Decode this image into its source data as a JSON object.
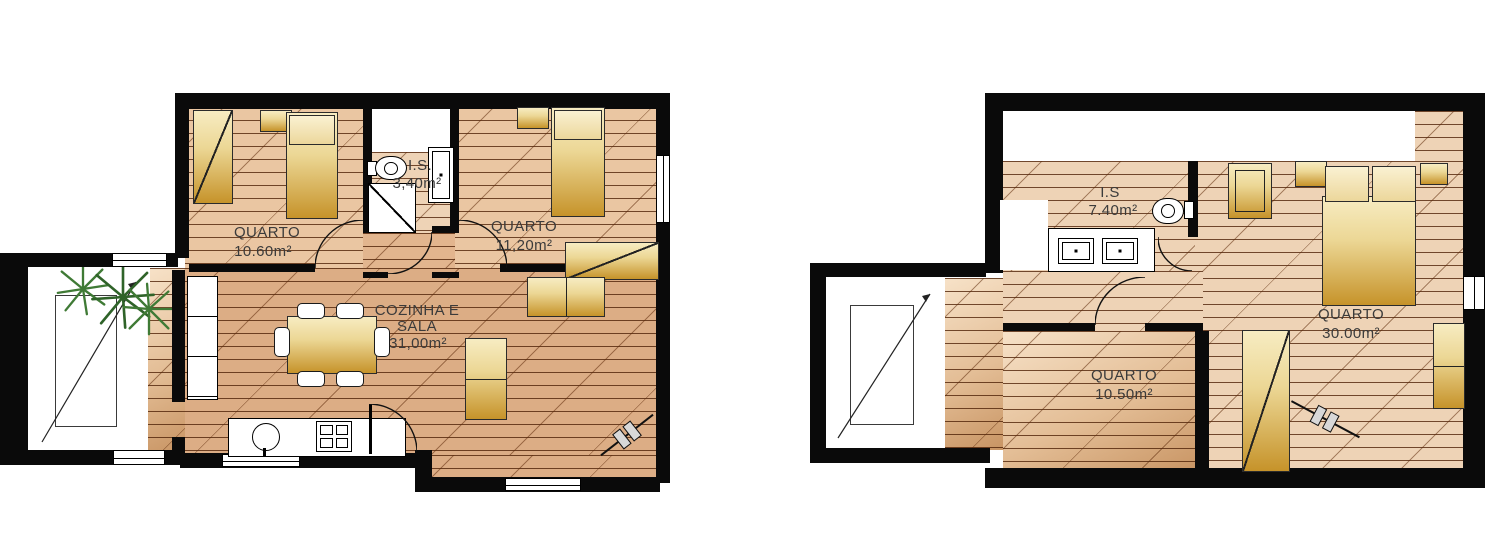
{
  "colors": {
    "wall": "#0a0a0a",
    "floor": "#e2b58e",
    "furniture": "#c6932a",
    "plant": "#3f7a35",
    "text": "#3b3b3b"
  },
  "plans": [
    {
      "label": "ground-floor",
      "rooms": [
        {
          "name": "QUARTO",
          "area": "10.60m²"
        },
        {
          "name": "I.S.",
          "area": "3,40m²"
        },
        {
          "name": "QUARTO",
          "area": "11,20m²"
        },
        {
          "name_line1": "COZINHA E",
          "name_line2": "SALA",
          "area": "31,00m²"
        }
      ]
    },
    {
      "label": "upper-floor",
      "rooms": [
        {
          "name": "I.S",
          "area": "7.40m²"
        },
        {
          "name": "QUARTO",
          "area": "30.00m²"
        },
        {
          "name": "QUARTO",
          "area": "10.50m²"
        }
      ]
    }
  ]
}
